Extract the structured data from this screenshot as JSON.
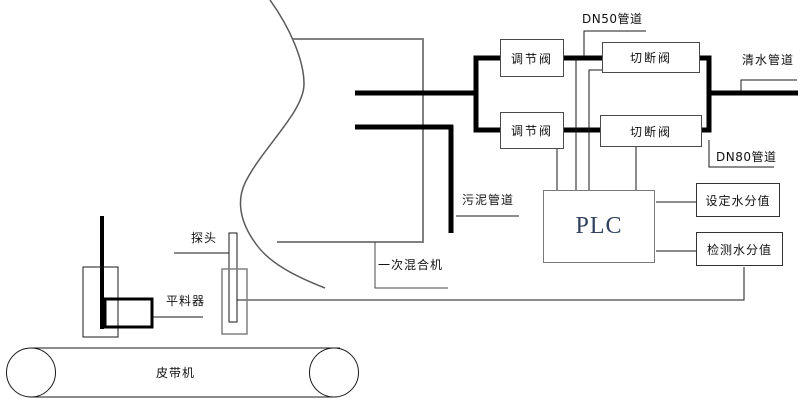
{
  "canvas": {
    "width": 800,
    "height": 406,
    "background": "#ffffff"
  },
  "colors": {
    "pipe_thick": "#000000",
    "signal_line": "#1a1a1a",
    "mixer_outline": "#808080",
    "boundary_curve": "#595959",
    "plc_text": "#32415f"
  },
  "diagram": {
    "pipe_labels": {
      "dn50": "DN50管道",
      "clean_water": "清水管道",
      "dn80": "DN80管道",
      "sludge": "污泥管道"
    },
    "equipment": {
      "mixer": "一次混合机",
      "probe": "探头",
      "leveler": "平料器",
      "belt": "皮带机",
      "plc": "PLC"
    },
    "valves": {
      "regulating_top": "调节阀",
      "cutoff_top": "切断阀",
      "regulating_bottom": "调节阀",
      "cutoff_bottom": "切断阀"
    },
    "signals": {
      "set_moisture": "设定水分值",
      "detect_moisture": "检测水分值"
    }
  }
}
